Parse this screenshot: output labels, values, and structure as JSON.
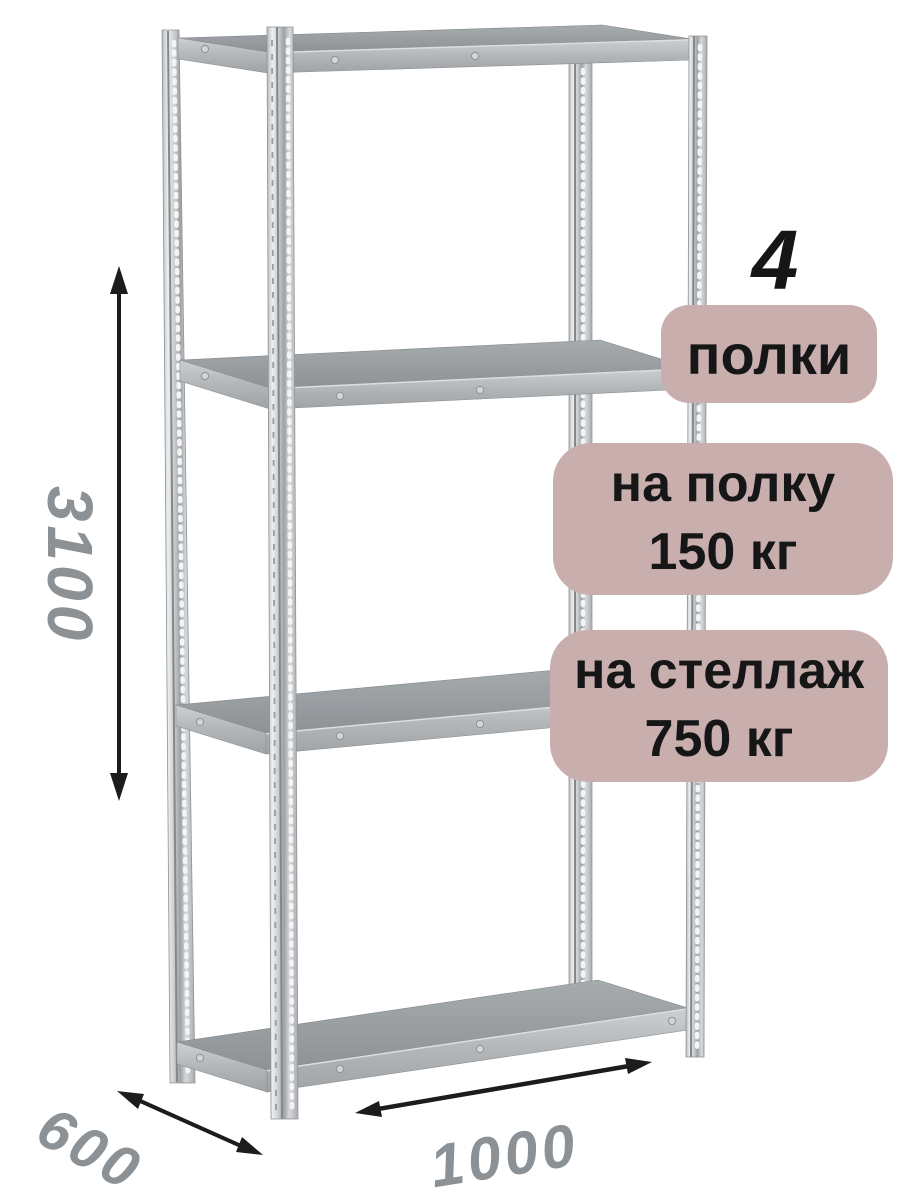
{
  "colors": {
    "background": "#ffffff",
    "badge_bg": "#c9aeae",
    "badge_text": "#161616",
    "dimension_text": "#8c9195",
    "arrow": "#1c1c1c",
    "metal_light": "#eceeef",
    "metal_mid": "#c2c5c8",
    "shelf_surface": "#989da1"
  },
  "badges": {
    "shelf_count": {
      "number": "4",
      "label": "полки"
    },
    "shelf_load": {
      "line1": "на полку",
      "line2": "150 кг"
    },
    "rack_load": {
      "line1": "на стеллаж",
      "line2": "750 кг"
    }
  },
  "dimensions": {
    "height": "3100",
    "depth": "600",
    "width": "1000"
  }
}
